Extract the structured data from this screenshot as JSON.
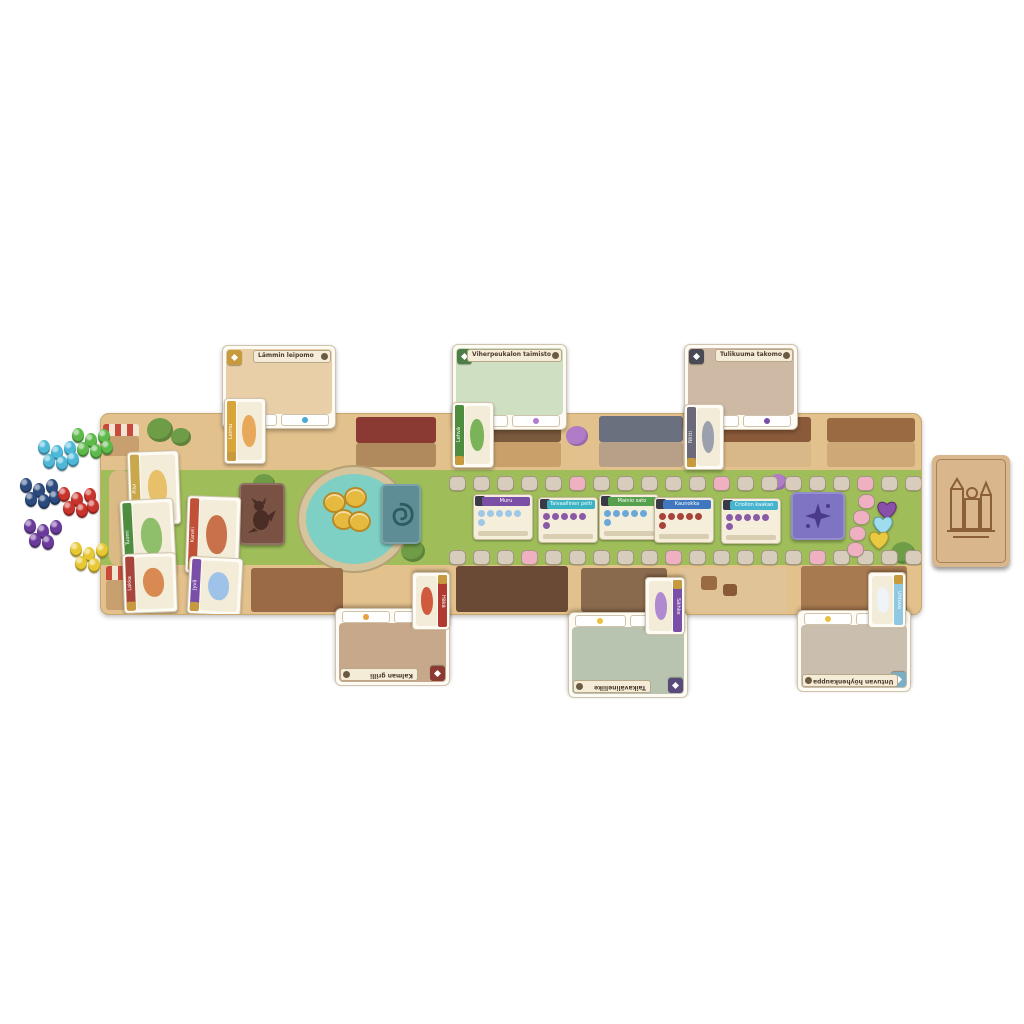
{
  "scene": {
    "background_hex": "#ffffff"
  },
  "board": {
    "path_hex": "#e3c18c",
    "grass_hex": "#9fbe5a",
    "track": {
      "top_count": 20,
      "bottom_count": 20,
      "space_hex": "#d8cdbd",
      "special_hex": "#efb1c1",
      "special_top": [
        5,
        11,
        17
      ],
      "special_bottom": [
        3,
        9,
        15
      ]
    },
    "hearts": [
      {
        "name": "purple-heart-token",
        "hex": "#8a4fa8"
      },
      {
        "name": "cyan-heart-token",
        "hex": "#9fdcec"
      },
      {
        "name": "yellow-heart-token",
        "hex": "#e9c93f"
      }
    ],
    "heart_spaces_hex": "#efb1c1"
  },
  "decks": {
    "dragon_deck": {
      "icon": "dragon-silhouette-icon",
      "hex": "#7a5244"
    },
    "enchantment_deck": {
      "icon": "flame-spiral-icon",
      "hex": "#5e8d96"
    },
    "fancy_deck": {
      "icon": "sparkle-icon",
      "hex": "#7f74c4"
    },
    "shop_deck": {
      "icon": "town-etching-icon",
      "hex": "#d9b68c"
    }
  },
  "coins": {
    "hex": "#e6b93f",
    "stacks": 4
  },
  "shops_top": [
    {
      "title": "Lämmin leipomo",
      "corner_hex": "#c79a3e",
      "art_hex": "#e8cfa8",
      "strip_dots": [
        "#e0a83c",
        "#f0e6d0",
        "#4aa8d8"
      ]
    },
    {
      "title": "Viherpeukalon taimisto",
      "corner_hex": "#4c7d46",
      "art_hex": "#cfe0c2",
      "strip_dots": [
        "#5a9a4a",
        "#e8c23c",
        "#b07cc8"
      ]
    },
    {
      "title": "Tulikuuma takomo",
      "corner_hex": "#4a4a55",
      "art_hex": "#cdb9a4",
      "strip_dots": [
        "#8a8a96",
        "#e8c23c",
        "#7a4fa8"
      ]
    }
  ],
  "shops_bottom": [
    {
      "title": "Kalman grilli",
      "corner_hex": "#8a3a32",
      "art_hex": "#c8a88a",
      "strip_dots": [
        "#4aa8d8",
        "#b8433a",
        "#e8a13c"
      ]
    },
    {
      "title": "Taikavälineliike",
      "corner_hex": "#5a4a7a",
      "art_hex": "#b8c4b0",
      "strip_dots": [
        "#8fd0e0",
        "#7a4fa8",
        "#e8c23c"
      ]
    },
    {
      "title": "Untuvan höyhenkauppa",
      "corner_hex": "#7aaec4",
      "art_hex": "#cabfae",
      "strip_dots": [
        "#8fd0e0",
        "#9aa0ad",
        "#e8c23c"
      ]
    }
  ],
  "goal_cards": [
    {
      "title": "Muru",
      "banner_hex": "#7b4fa6",
      "dot_hex": "#9ec7e8"
    },
    {
      "title": "Taivaallinen pelti",
      "banner_hex": "#3bb3c4",
      "dot_hex": "#8a5aa8"
    },
    {
      "title": "Mainio sato",
      "banner_hex": "#57a04e",
      "dot_hex": "#6aa8d8"
    },
    {
      "title": "Kaunokka",
      "banner_hex": "#3f78bf",
      "dot_hex": "#a8433a"
    },
    {
      "title": "Criollon kaakao",
      "banner_hex": "#46b4cf",
      "dot_hex": "#8a5aa8"
    }
  ],
  "dragons_on_board": [
    {
      "name": "Pilvi",
      "band_hex": "#c9a84c",
      "body_hex": "#e8c06a"
    },
    {
      "name": "Tuomi",
      "band_hex": "#4e8d3f",
      "body_hex": "#8fbf6a"
    },
    {
      "name": "Kaneli",
      "band_hex": "#c05038",
      "body_hex": "#c8714a"
    },
    {
      "name": "Lakka",
      "band_hex": "#a8453a",
      "body_hex": "#d88a52"
    },
    {
      "name": "Jyvä",
      "band_hex": "#7a4fa8",
      "body_hex": "#9fc3e8"
    }
  ],
  "dragons_overlap": [
    {
      "name": "Leimu",
      "band_hex": "#d8a43c",
      "body_hex": "#e8a85a"
    },
    {
      "name": "Lehvä",
      "band_hex": "#4e8d3f",
      "body_hex": "#7ab35a"
    },
    {
      "name": "Niitti",
      "band_hex": "#6a6a78",
      "body_hex": "#9aa0ad"
    },
    {
      "name": "Häkä",
      "band_hex": "#b03a32",
      "body_hex": "#d05a3e"
    },
    {
      "name": "Säihke",
      "band_hex": "#7a4fa8",
      "body_hex": "#b08ad0"
    },
    {
      "name": "Untuva",
      "band_hex": "#8fc8e0",
      "body_hex": "#eef4f8"
    }
  ],
  "token_clusters": [
    {
      "color_name": "cyan",
      "hex": "#4db8d8",
      "count": 6
    },
    {
      "color_name": "green",
      "hex": "#5cb94a",
      "count": 6
    },
    {
      "color_name": "navy",
      "hex": "#2b4a7d",
      "count": 6
    },
    {
      "color_name": "red",
      "hex": "#c8332b",
      "count": 6
    },
    {
      "color_name": "purple",
      "hex": "#6a3b9c",
      "count": 5
    },
    {
      "color_name": "yellow",
      "hex": "#e8c832",
      "count": 5
    }
  ]
}
